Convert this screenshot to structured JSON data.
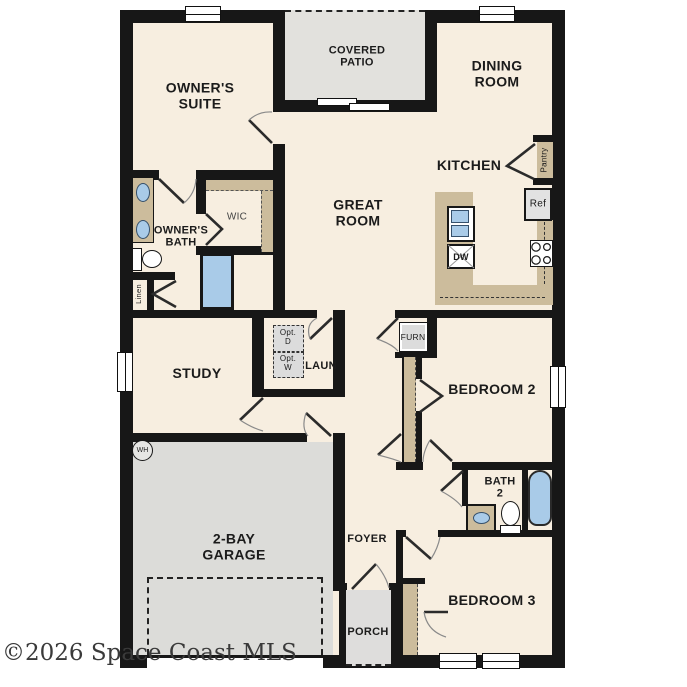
{
  "plan": {
    "rooms": {
      "owners_suite": "OWNER'S\nSUITE",
      "covered_patio": "COVERED\nPATIO",
      "dining_room": "DINING\nROOM",
      "great_room": "GREAT\nROOM",
      "kitchen": "KITCHEN",
      "owners_bath": "OWNER'S\nBATH",
      "wic": "WIC",
      "study": "STUDY",
      "laundry": "LAUN",
      "bedroom2": "BEDROOM 2",
      "bath2": "BATH\n2",
      "bedroom3": "BEDROOM 3",
      "foyer": "FOYER",
      "porch": "PORCH",
      "garage": "2-BAY\nGARAGE"
    },
    "fixtures": {
      "pantry": "Pantry",
      "ref": "Ref",
      "dw": "DW",
      "furnace": "FURN",
      "opt_dryer": "Opt.\nD",
      "opt_washer": "Opt.\nW",
      "linen": "Linen",
      "water_heater": "WH"
    },
    "colors": {
      "floor": "#f7eee0",
      "wall": "#171717",
      "patio_gray": "#e2e1dd",
      "garage_gray": "#dcdcd9",
      "counter_tan": "#ccbc9c",
      "fixture_blue": "#a9cbe8"
    }
  },
  "watermark": "©2026 Space Coast MLS"
}
